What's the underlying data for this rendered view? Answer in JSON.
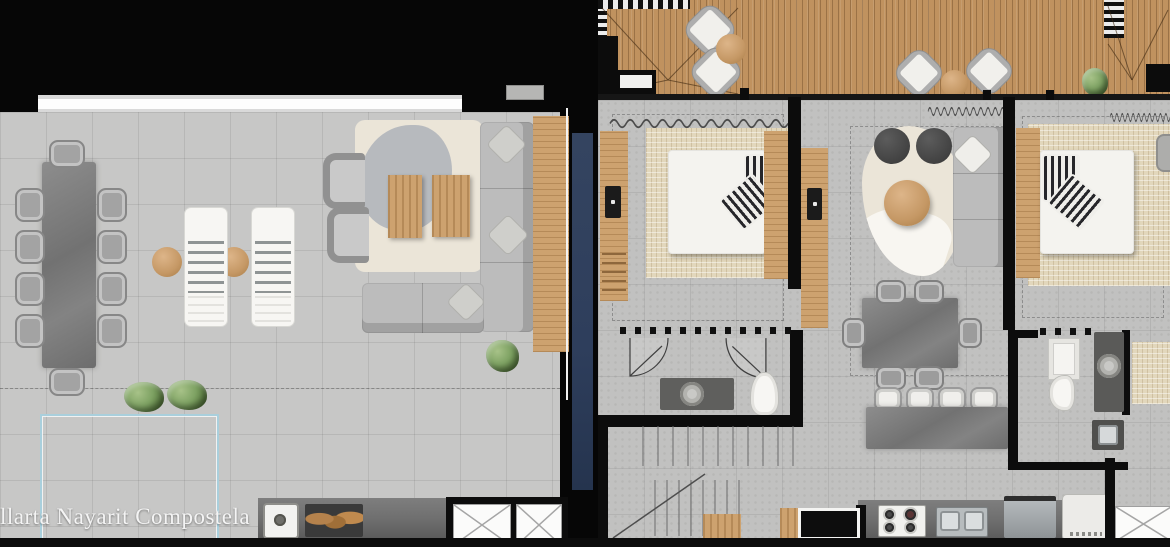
{
  "meta": {
    "kind": "architectural floor plan, two units side by side, top view"
  },
  "watermark": {
    "text": "llarta Nayarit Compostela"
  },
  "colors": {
    "background": "#060606",
    "floor-left": "#c7c7c6",
    "floor-right": "#c1c1c0",
    "deck-wood": "#c0925f",
    "wood": "#cda26f",
    "navy": "#2e3e5c",
    "rail": "#a9cfdc",
    "stone": "#7f7f7f",
    "sofa": "#bcbcbc",
    "rug-cream": "#ebe5d8",
    "rug-beige": "#e2d7bc",
    "plant": "#7ea263",
    "counter": "#6e6e6e",
    "wall": "#0c0c0c"
  },
  "left_unit": {
    "label": "roof terrace unit",
    "furniture": [
      "10-seat stone dining table",
      "two sun loungers with side tables",
      "two armchairs",
      "L-shaped sectional sofa with pillows",
      "two wood coffee tables on area rug",
      "wood deck strip",
      "glass pool railing",
      "three green planters",
      "outdoor counter with sink and wood grill",
      "two elevator shafts"
    ]
  },
  "right_unit": {
    "label": "apartment unit",
    "furniture": [
      "wood roof deck with four lounge chairs, two round tables and planter",
      "bedroom 1: bed, striped pillows, wood headboard, TV console, beige rug",
      "living room: sofa, two poufs, round coffee table, organic rug, TV console",
      "6-seat dining table",
      "kitchen island with four stools",
      "kitchen counter: stove, double sink, dishwasher, refrigerator",
      "bathroom 1: vanity with round sink, toilet, two door swings",
      "bathroom 2: shower tray, toilet, vanity, laundry sink",
      "bedroom 2: bed with wood headboard, beige rug, armchair",
      "staircase",
      "elevator shaft"
    ]
  }
}
